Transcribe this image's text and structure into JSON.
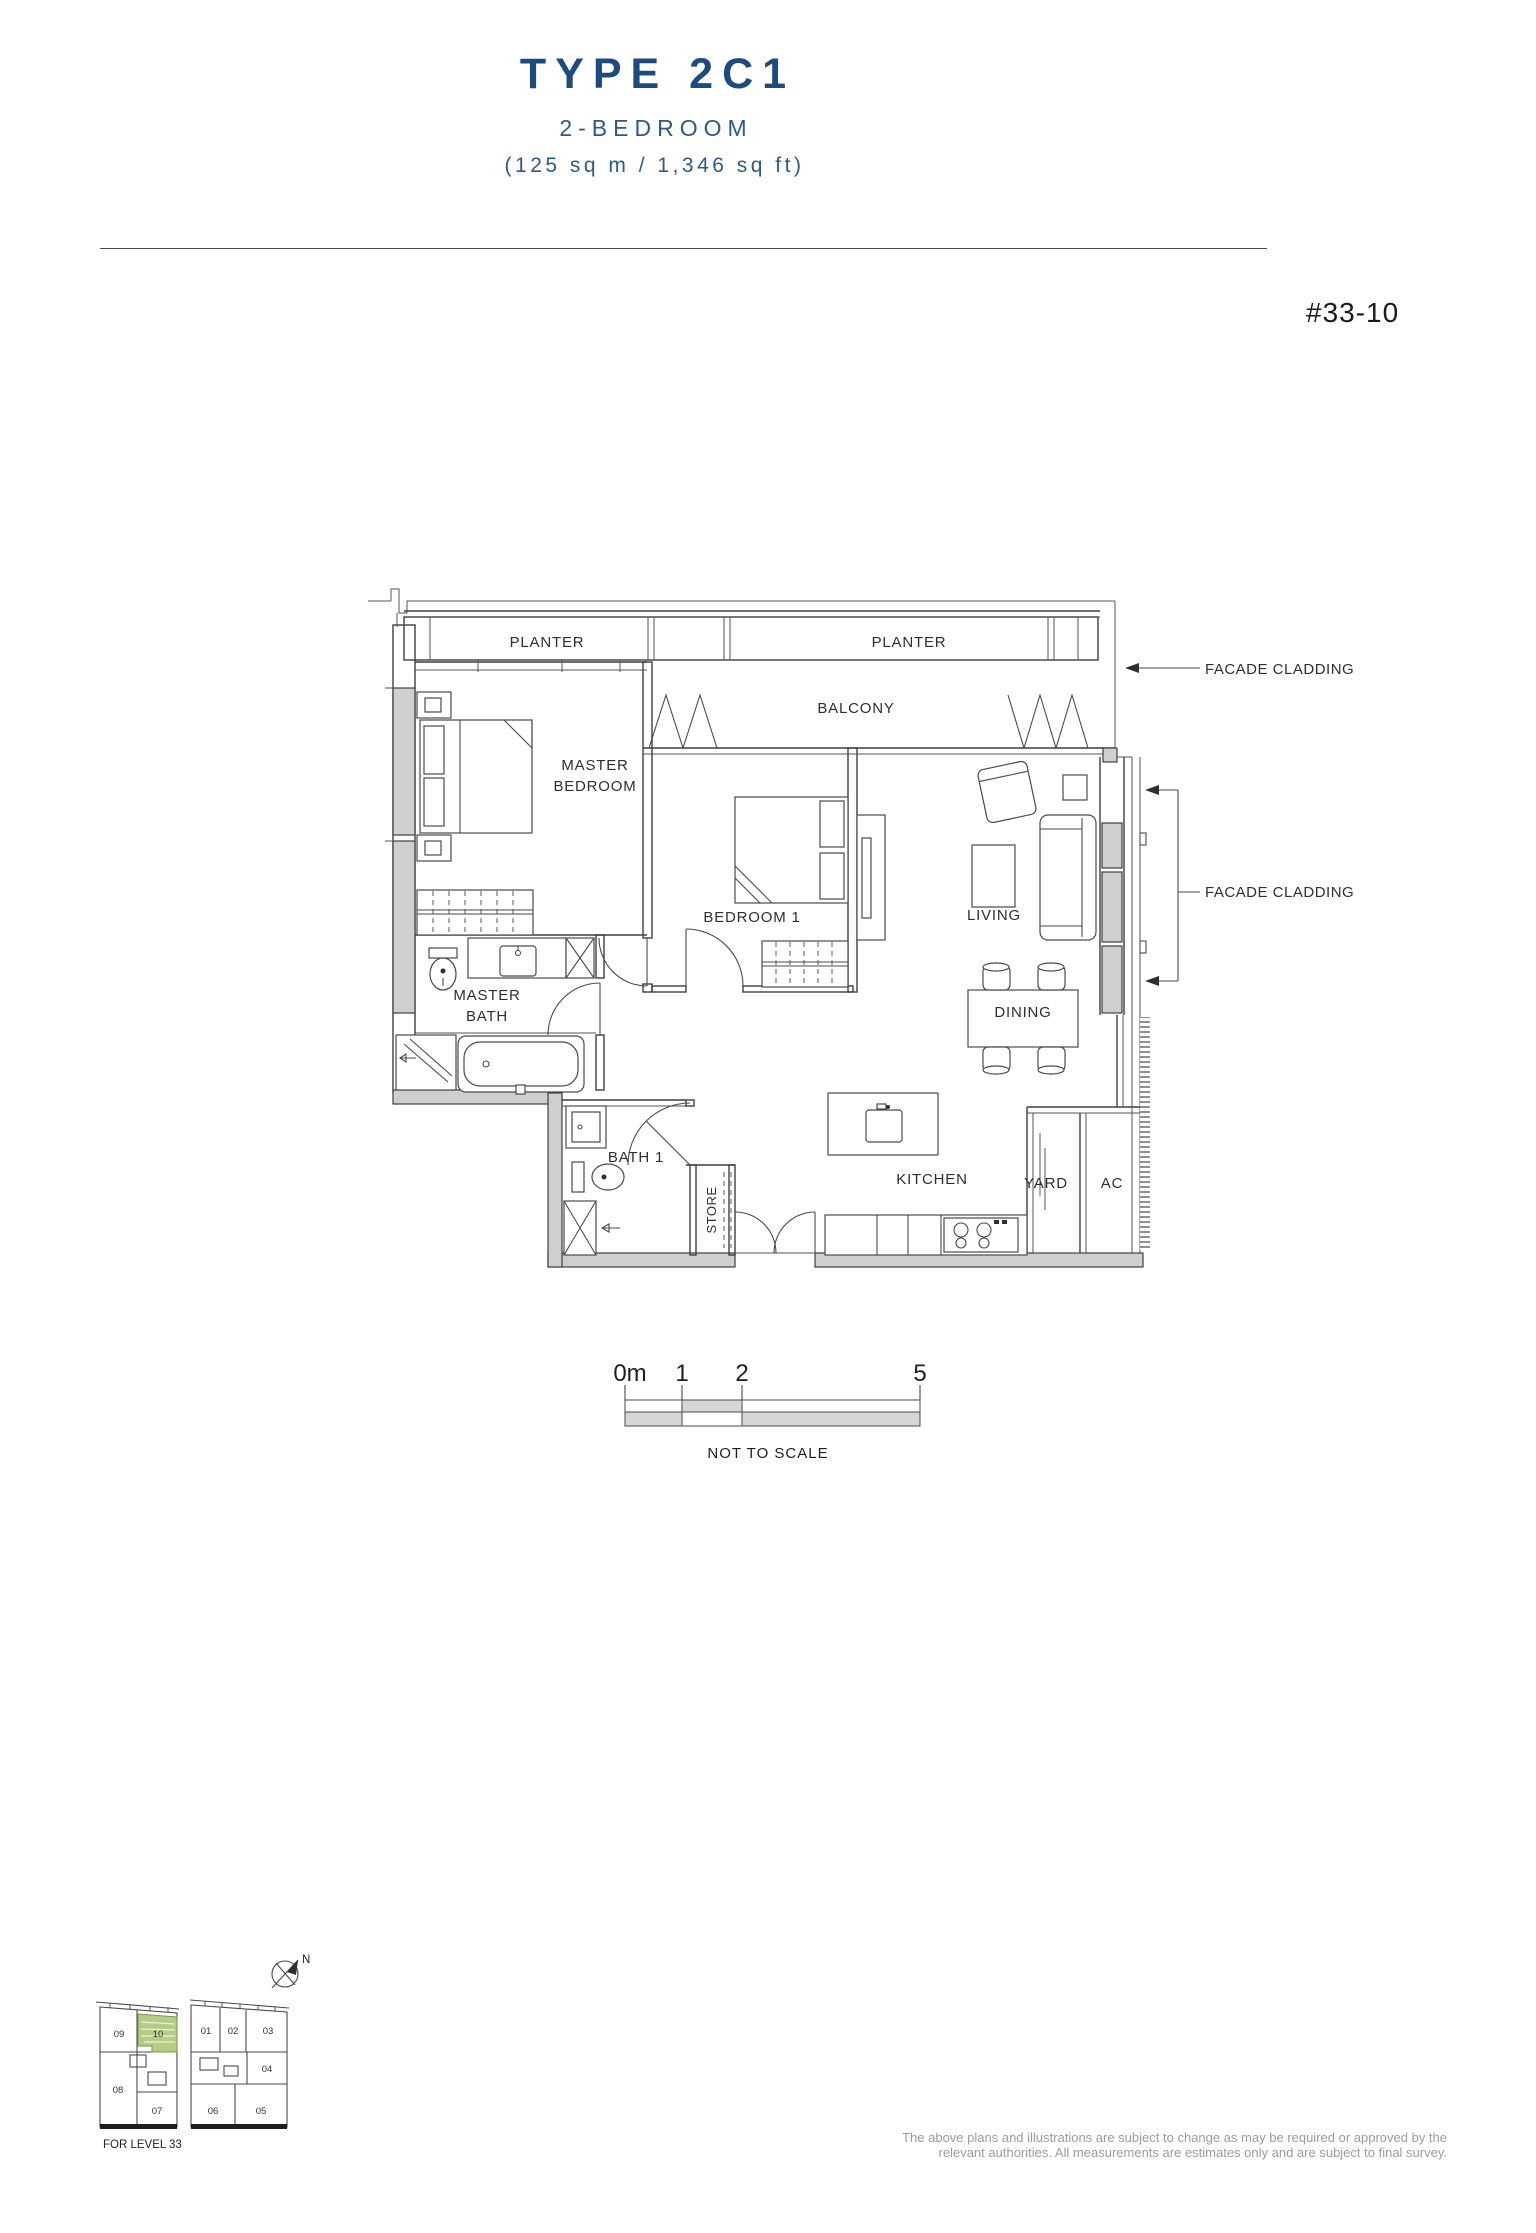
{
  "header": {
    "type_title": "TYPE 2C1",
    "subtitle": "2-BEDROOM",
    "area": "(125 sq m / 1,346 sq ft)",
    "unit_number": "#33-10"
  },
  "plan": {
    "labels": {
      "planter_left": "PLANTER",
      "planter_right": "PLANTER",
      "balcony": "BALCONY",
      "master_bedroom_line1": "MASTER",
      "master_bedroom_line2": "BEDROOM",
      "bedroom1": "BEDROOM 1",
      "living": "LIVING",
      "dining": "DINING",
      "kitchen": "KITCHEN",
      "yard": "YARD",
      "ac": "AC",
      "master_bath_line1": "MASTER",
      "master_bath_line2": "BATH",
      "bath1": "BATH 1",
      "store": "STORE"
    },
    "annotations": {
      "facade_cladding_top": "FACADE CLADDING",
      "facade_cladding_right": "FACADE CLADDING"
    }
  },
  "scale_bar": {
    "tick_0": "0m",
    "tick_1": "1",
    "tick_2": "2",
    "tick_5": "5",
    "note": "NOT TO SCALE"
  },
  "key_plan": {
    "level_label": "FOR LEVEL 33",
    "north_label": "N",
    "highlighted_unit": "10",
    "units": {
      "u01": "01",
      "u02": "02",
      "u03": "03",
      "u04": "04",
      "u05": "05",
      "u06": "06",
      "u07": "07",
      "u08": "08",
      "u09": "09",
      "u10": "10"
    }
  },
  "footer": {
    "disclaimer_line1": "The above plans and illustrations are subject to change as may be required or approved by the",
    "disclaimer_line2": "relevant authorities. All measurements are estimates only and are subject to final survey."
  },
  "colors": {
    "title_navy": "#1d4b80",
    "subtitle_navy": "#2f5a85",
    "highlight_green": "#b5cc86",
    "plan_line": "#3f3f3f",
    "wall_gray": "#cfcfcf",
    "disclaimer_gray": "#9c9c9c"
  }
}
